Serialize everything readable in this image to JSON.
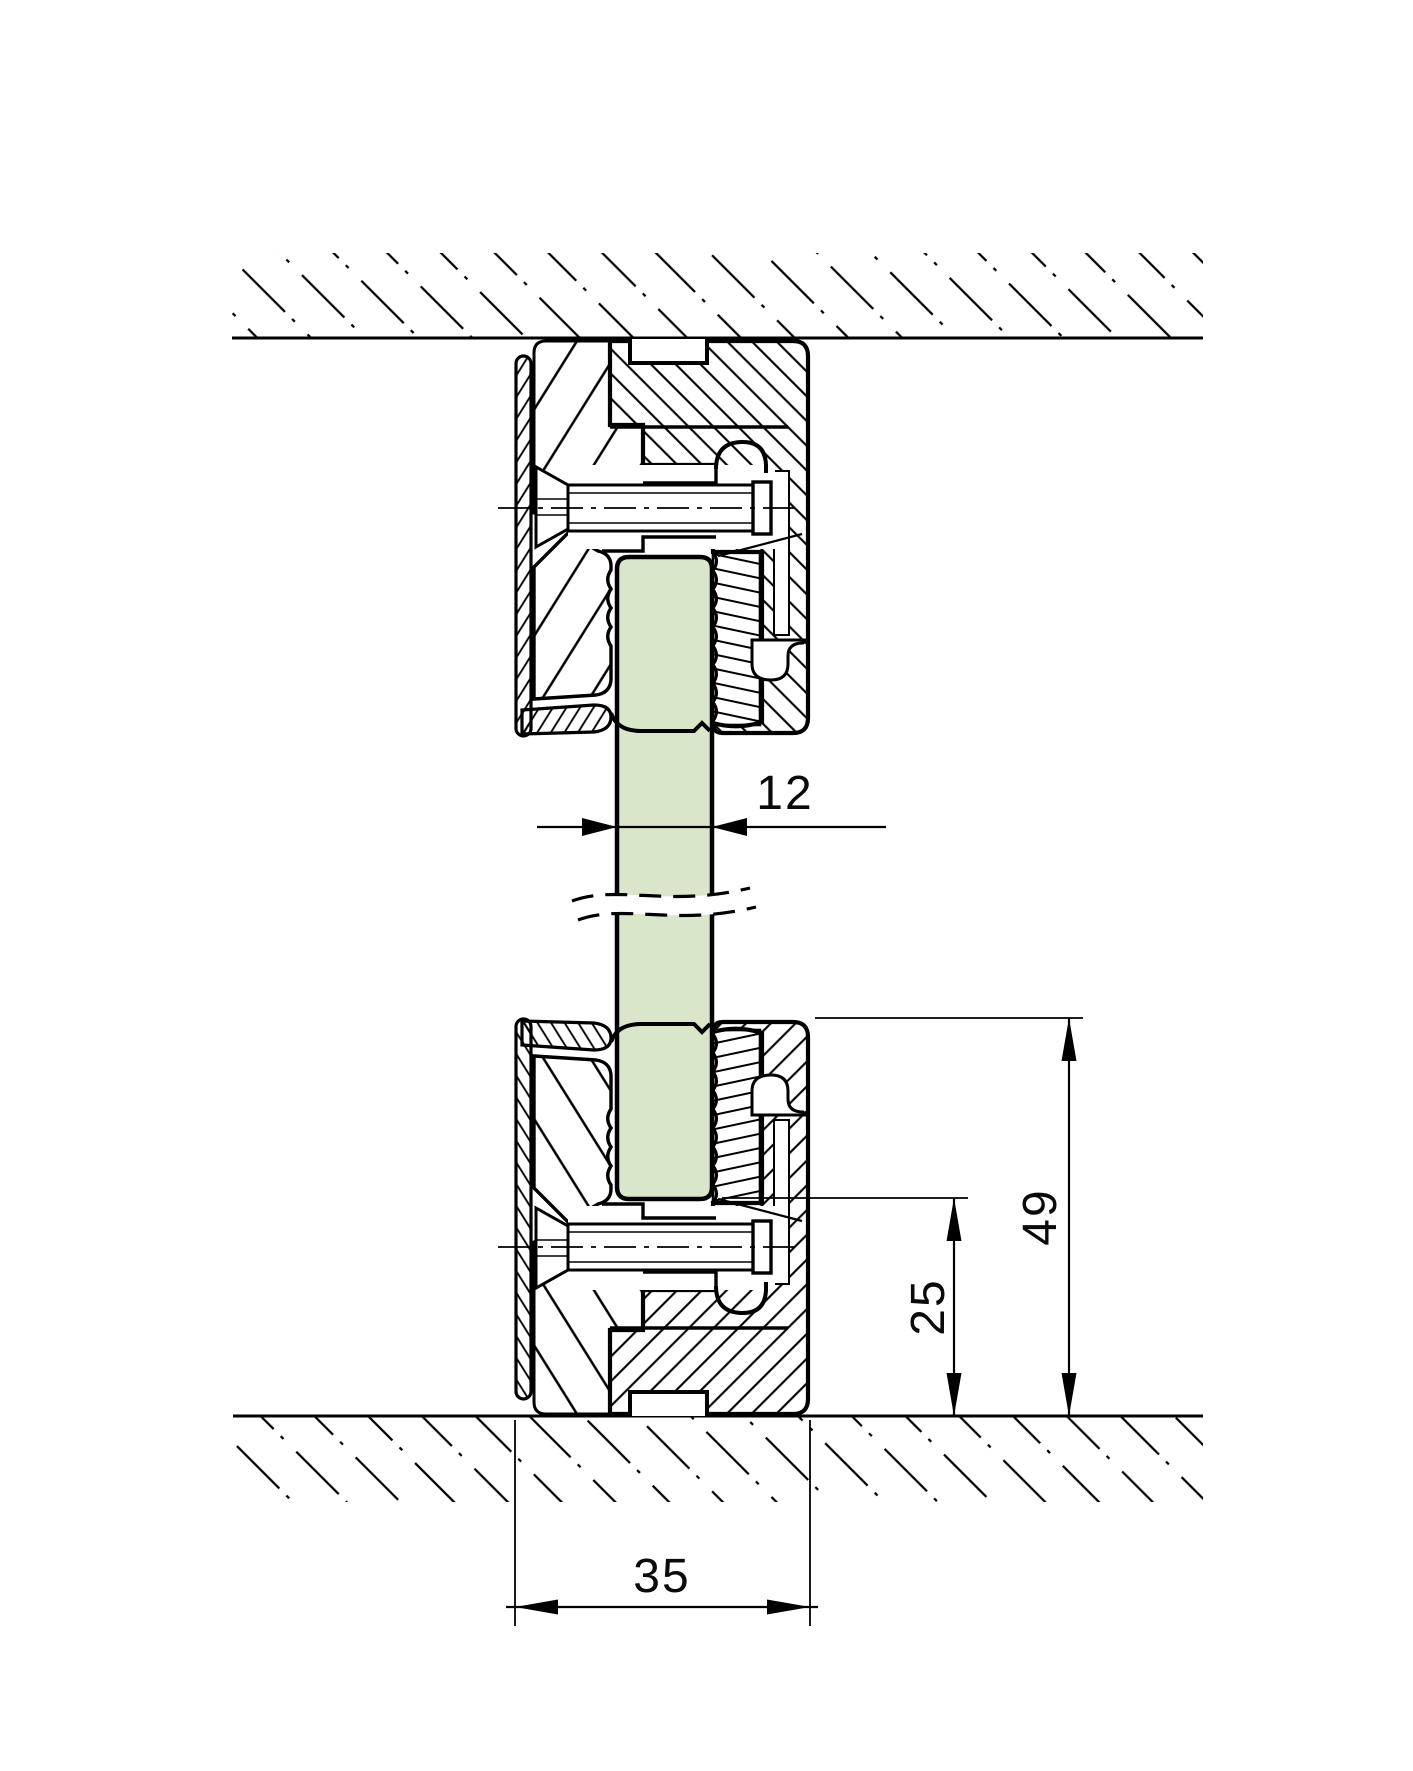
{
  "drawing": {
    "kind": "technical-section",
    "subject": "glass-partition-clamp-profile-vertical-section"
  },
  "dimensions": {
    "glass_thickness": "12",
    "profile_height": "49",
    "glass_edge_offset": "25",
    "profile_width": "35"
  },
  "colors": {
    "glass_fill": "#d9e6c9",
    "line": "#000000",
    "paper": "#ffffff"
  }
}
